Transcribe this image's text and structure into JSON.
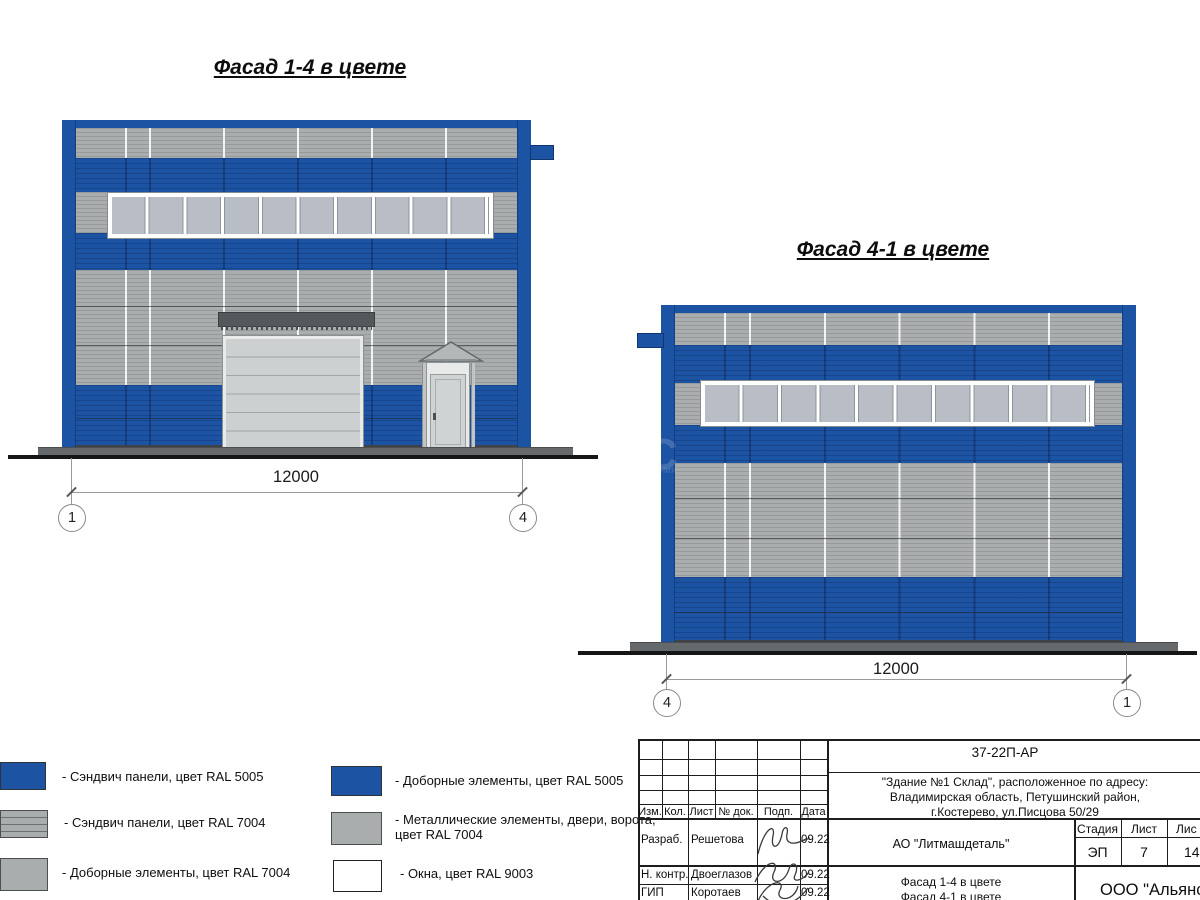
{
  "colors": {
    "ral5005": "#1c53a3",
    "ral7004": "#a9adae",
    "ral9003": "#ffffff",
    "pane": "#b8bdc6",
    "metal": "#cdd0d0"
  },
  "facades": [
    {
      "title": "Фасад 1-4 в цвете",
      "dimension": "12000",
      "axis_left": "1",
      "axis_right": "4"
    },
    {
      "title": "Фасад 4-1 в цвете",
      "dimension": "12000",
      "axis_left": "4",
      "axis_right": "1"
    }
  ],
  "watermark": {
    "big": "С",
    "small": "вания"
  },
  "legend": {
    "items": [
      {
        "label": "- Сэндвич панели, цвет RAL 5005"
      },
      {
        "label": "- Сэндвич панели, цвет RAL 7004"
      },
      {
        "label": "- Доборные элементы, цвет RAL 7004"
      },
      {
        "label": "- Доборные элементы, цвет RAL 5005"
      },
      {
        "label": "- Металлические элементы, двери, ворота,\nцвет RAL 7004"
      },
      {
        "label": "- Окна, цвет RAL 9003"
      }
    ]
  },
  "titleblock": {
    "doc_code": "37-22П-АР",
    "address": "\"Здание №1 Склад\", расположенное по адресу:\nВладимирская область, Петушинский район,\nг.Костерево, ул.Писцова 50/29",
    "cols": {
      "izm": "Изм.",
      "kol": "Кол.",
      "list": "Лист",
      "doc": "№ док.",
      "podp": "Подп.",
      "data": "Дата"
    },
    "rows": [
      {
        "role": "Разраб.",
        "name": "Решетова",
        "date": "09.22"
      },
      {
        "role": "Н. контр.",
        "name": "Двоеглазов",
        "date": "09.22"
      },
      {
        "role": "ГИП",
        "name": "Коротаев",
        "date": "09.22"
      }
    ],
    "company": "АО \"Литмашдеталь\"",
    "stage_label": "Стадия",
    "sheet_label": "Лист",
    "sheets_label": "Лис",
    "stage_value": "ЭП",
    "sheet_value": "7",
    "sheets_value": "14",
    "sheet_titles": "Фасад 1-4 в цвете\nФасад 4-1 в цвете",
    "company2": "ООО \"Альянс"
  }
}
